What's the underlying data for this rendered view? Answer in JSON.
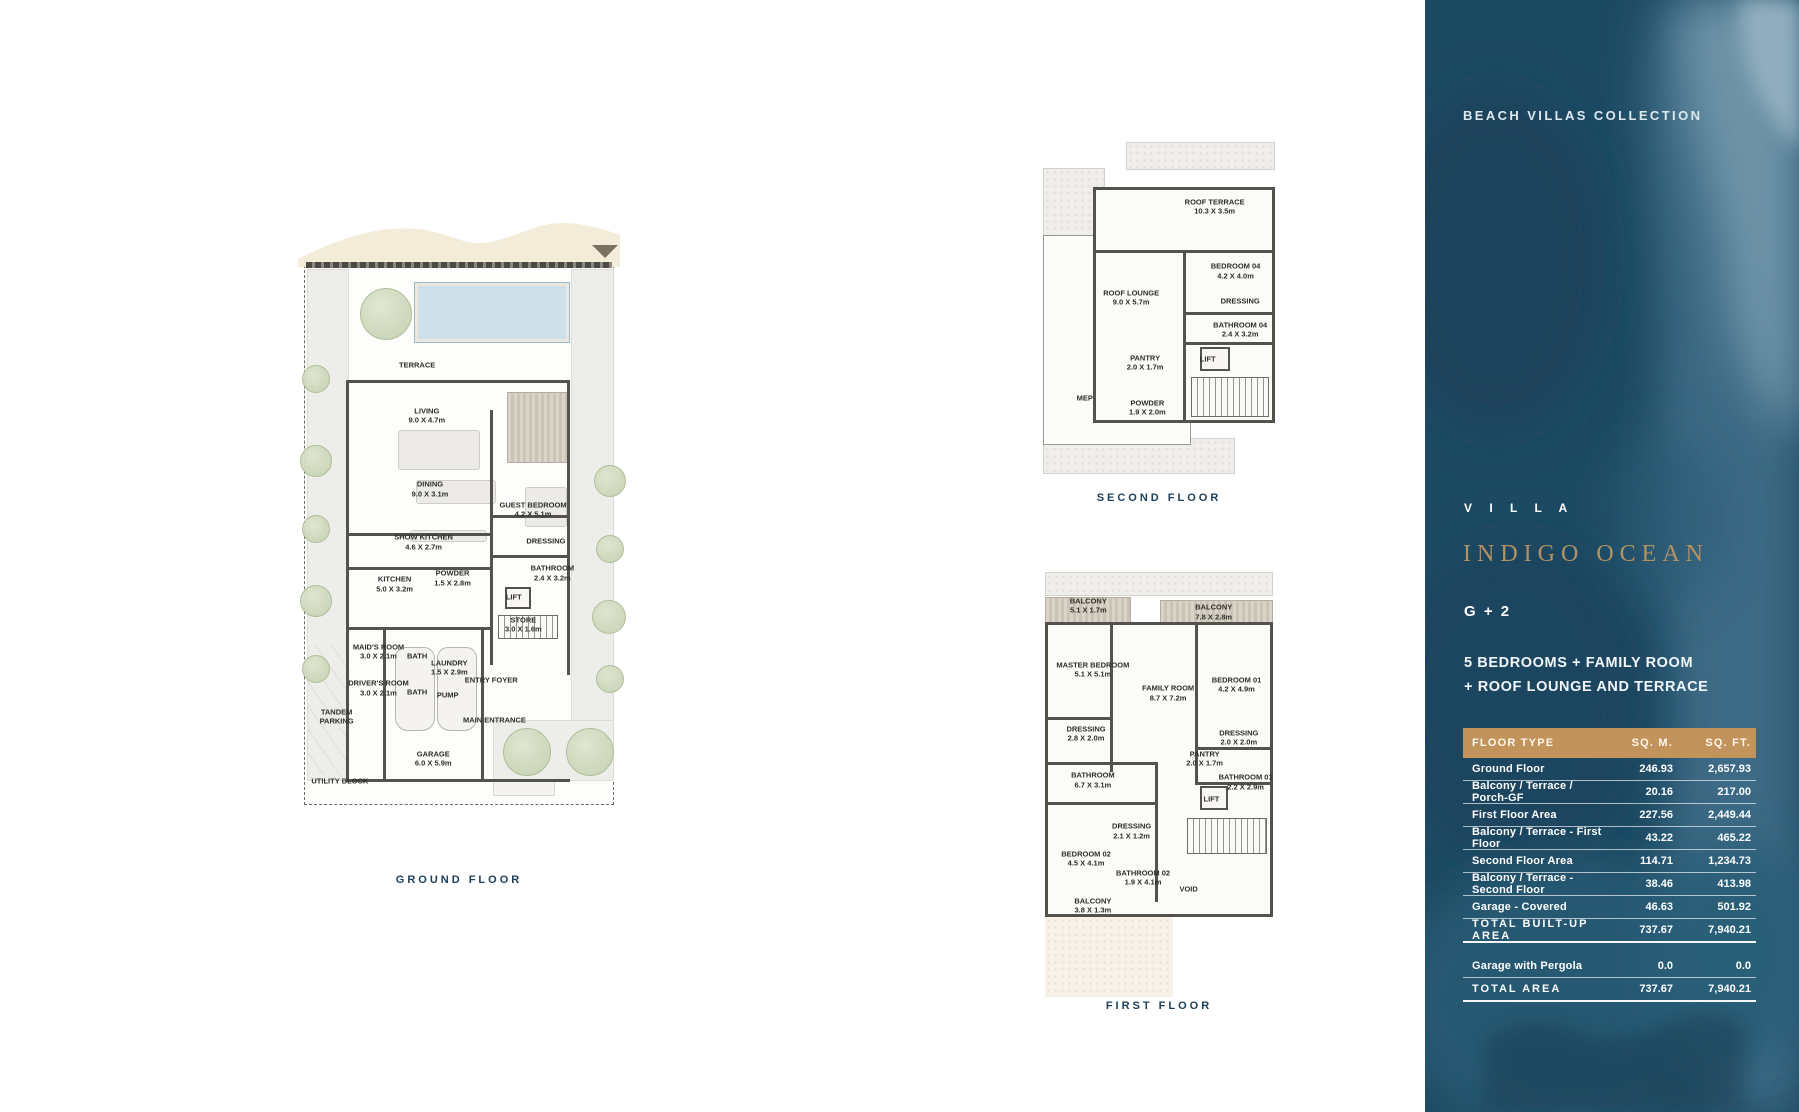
{
  "sidebar": {
    "collection_title": "BEACH VILLAS COLLECTION",
    "villa_label": "V I L L A",
    "villa_name": "INDIGO OCEAN",
    "storeys": "G + 2",
    "features_line1": "5 BEDROOMS + FAMILY ROOM",
    "features_line2": "+ ROOF LOUNGE AND TERRACE",
    "colors": {
      "sidebar_background": "#1d4a63",
      "table_header": "#c2945c",
      "accent_gold": "#b29263",
      "text": "#ffffff",
      "caption_teal": "#1e4058"
    },
    "table": {
      "headers": [
        "FLOOR TYPE",
        "SQ. M.",
        "SQ. FT."
      ],
      "rows": [
        {
          "label": "Ground Floor",
          "sqm": "246.93",
          "sqft": "2,657.93"
        },
        {
          "label": "Balcony / Terrace / Porch-GF",
          "sqm": "20.16",
          "sqft": "217.00"
        },
        {
          "label": "First Floor Area",
          "sqm": "227.56",
          "sqft": "2,449.44"
        },
        {
          "label": "Balcony / Terrace - First Floor",
          "sqm": "43.22",
          "sqft": "465.22"
        },
        {
          "label": "Second Floor Area",
          "sqm": "114.71",
          "sqft": "1,234.73"
        },
        {
          "label": "Balcony / Terrace - Second Floor",
          "sqm": "38.46",
          "sqft": "413.98"
        },
        {
          "label": "Garage - Covered",
          "sqm": "46.63",
          "sqft": "501.92"
        },
        {
          "label": "TOTAL BUILT-UP AREA",
          "sqm": "737.67",
          "sqft": "7,940.21",
          "class": "total"
        },
        {
          "label": "",
          "sqm": "",
          "sqft": "",
          "class": "spacer"
        },
        {
          "label": "Garage with Pergola",
          "sqm": "0.0",
          "sqft": "0.0"
        },
        {
          "label": "TOTAL AREA",
          "sqm": "737.67",
          "sqft": "7,940.21",
          "class": "total"
        }
      ]
    }
  },
  "plans": {
    "ground": {
      "caption": "GROUND FLOOR",
      "rooms": [
        {
          "label": "TERRACE",
          "x": "37%",
          "y": "25.5%"
        },
        {
          "label": "LIVING",
          "dims": "9.0 X 4.7m",
          "x": "40%",
          "y": "34%"
        },
        {
          "label": "DINING",
          "dims": "9.0 X 3.1m",
          "x": "41%",
          "y": "46.5%"
        },
        {
          "label": "SHOW KITCHEN",
          "dims": "4.6 X 2.7m",
          "x": "39%",
          "y": "55.5%"
        },
        {
          "label": "GUEST BEDROOM",
          "dims": "4.2 X 5.1m",
          "x": "73%",
          "y": "50%"
        },
        {
          "label": "DRESSING",
          "x": "77%",
          "y": "55.3%"
        },
        {
          "label": "BATHROOM",
          "dims": "2.4 X 3.2m",
          "x": "79%",
          "y": "60.7%"
        },
        {
          "label": "KITCHEN",
          "dims": "5.0 X 3.2m",
          "x": "30%",
          "y": "62.6%"
        },
        {
          "label": "POWDER",
          "dims": "1.5 X 2.8m",
          "x": "48%",
          "y": "61.6%"
        },
        {
          "label": "LIFT",
          "x": "67%",
          "y": "64.8%"
        },
        {
          "label": "STORE",
          "dims": "3.0 X 1.6m",
          "x": "70%",
          "y": "69.5%"
        },
        {
          "label": "MAID'S ROOM",
          "dims": "3.0 X 2.1m",
          "x": "25%",
          "y": "74%"
        },
        {
          "label": "BATH",
          "x": "37%",
          "y": "74.8%"
        },
        {
          "label": "LAUNDRY",
          "dims": "1.5 X 2.9m",
          "x": "47%",
          "y": "76.8%"
        },
        {
          "label": "DRIVER'S ROOM",
          "dims": "3.0 X 2.1m",
          "x": "25%",
          "y": "80.2%"
        },
        {
          "label": "BATH",
          "x": "37%",
          "y": "80.9%"
        },
        {
          "label": "PUMP",
          "x": "46.5%",
          "y": "81.4%"
        },
        {
          "label": "ENTRY FOYER",
          "x": "60%",
          "y": "78.8%"
        },
        {
          "label": "MAIN ENTRANCE",
          "x": "61%",
          "y": "85.6%"
        },
        {
          "label": "TANDEM",
          "dims": "PARKING",
          "x": "12%",
          "y": "85%"
        },
        {
          "label": "GARAGE",
          "dims": "6.0 X 5.9m",
          "x": "42%",
          "y": "92.2%"
        },
        {
          "label": "UTILITY BLOCK",
          "x": "13%",
          "y": "96%"
        }
      ]
    },
    "second": {
      "caption": "SECOND FLOOR",
      "rooms": [
        {
          "label": "ROOF TERRACE",
          "dims": "10.3 X 3.5m",
          "x": "74%",
          "y": "19.5%"
        },
        {
          "label": "BEDROOM 04",
          "dims": "4.2 X 4.0m",
          "x": "83%",
          "y": "39%"
        },
        {
          "label": "DRESSING",
          "x": "85%",
          "y": "48%"
        },
        {
          "label": "ROOF LOUNGE",
          "dims": "9.0 X 5.7m",
          "x": "38%",
          "y": "47%"
        },
        {
          "label": "BATHROOM 04",
          "dims": "2.4 X 3.2m",
          "x": "85%",
          "y": "56.5%"
        },
        {
          "label": "LIFT",
          "x": "71%",
          "y": "65.5%"
        },
        {
          "label": "PANTRY",
          "dims": "2.0 X 1.7m",
          "x": "44%",
          "y": "66.5%"
        },
        {
          "label": "MEP",
          "x": "18%",
          "y": "77%"
        },
        {
          "label": "POWDER",
          "dims": "1.9 X 2.0m",
          "x": "45%",
          "y": "80%"
        }
      ]
    },
    "first": {
      "caption": "FIRST FLOOR",
      "rooms": [
        {
          "label": "BALCONY",
          "dims": "5.1 X 1.7m",
          "x": "19%",
          "y": "8%"
        },
        {
          "label": "BALCONY",
          "dims": "7.8 X 2.8m",
          "x": "74%",
          "y": "9.5%"
        },
        {
          "label": "MASTER BEDROOM",
          "dims": "5.1 X 5.1m",
          "x": "21%",
          "y": "23%"
        },
        {
          "label": "FAMILY ROOM",
          "dims": "8.7 X 7.2m",
          "x": "54%",
          "y": "28.5%"
        },
        {
          "label": "BEDROOM 01",
          "dims": "4.2 X 4.9m",
          "x": "84%",
          "y": "26.5%"
        },
        {
          "label": "DRESSING",
          "dims": "2.8 X 2.0m",
          "x": "18%",
          "y": "38%"
        },
        {
          "label": "DRESSING",
          "dims": "2.0 X 2.0m",
          "x": "85%",
          "y": "39%"
        },
        {
          "label": "PANTRY",
          "dims": "2.0 X 1.7m",
          "x": "70%",
          "y": "44%"
        },
        {
          "label": "BATHROOM",
          "dims": "6.7 X 3.1m",
          "x": "21%",
          "y": "49%"
        },
        {
          "label": "BATHROOM 01",
          "dims": "2.2 X 2.9m",
          "x": "88%",
          "y": "49.5%"
        },
        {
          "label": "LIFT",
          "x": "73%",
          "y": "53.5%"
        },
        {
          "label": "DRESSING",
          "dims": "2.1 X 1.2m",
          "x": "38%",
          "y": "61%"
        },
        {
          "label": "BEDROOM 02",
          "dims": "4.5 X 4.1m",
          "x": "18%",
          "y": "67.5%"
        },
        {
          "label": "BATHROOM 02",
          "dims": "1.9 X 4.1m",
          "x": "43%",
          "y": "72%"
        },
        {
          "label": "VOID",
          "x": "63%",
          "y": "74.5%"
        },
        {
          "label": "BALCONY",
          "dims": "3.8 X 1.3m",
          "x": "21%",
          "y": "78.5%"
        }
      ]
    }
  }
}
